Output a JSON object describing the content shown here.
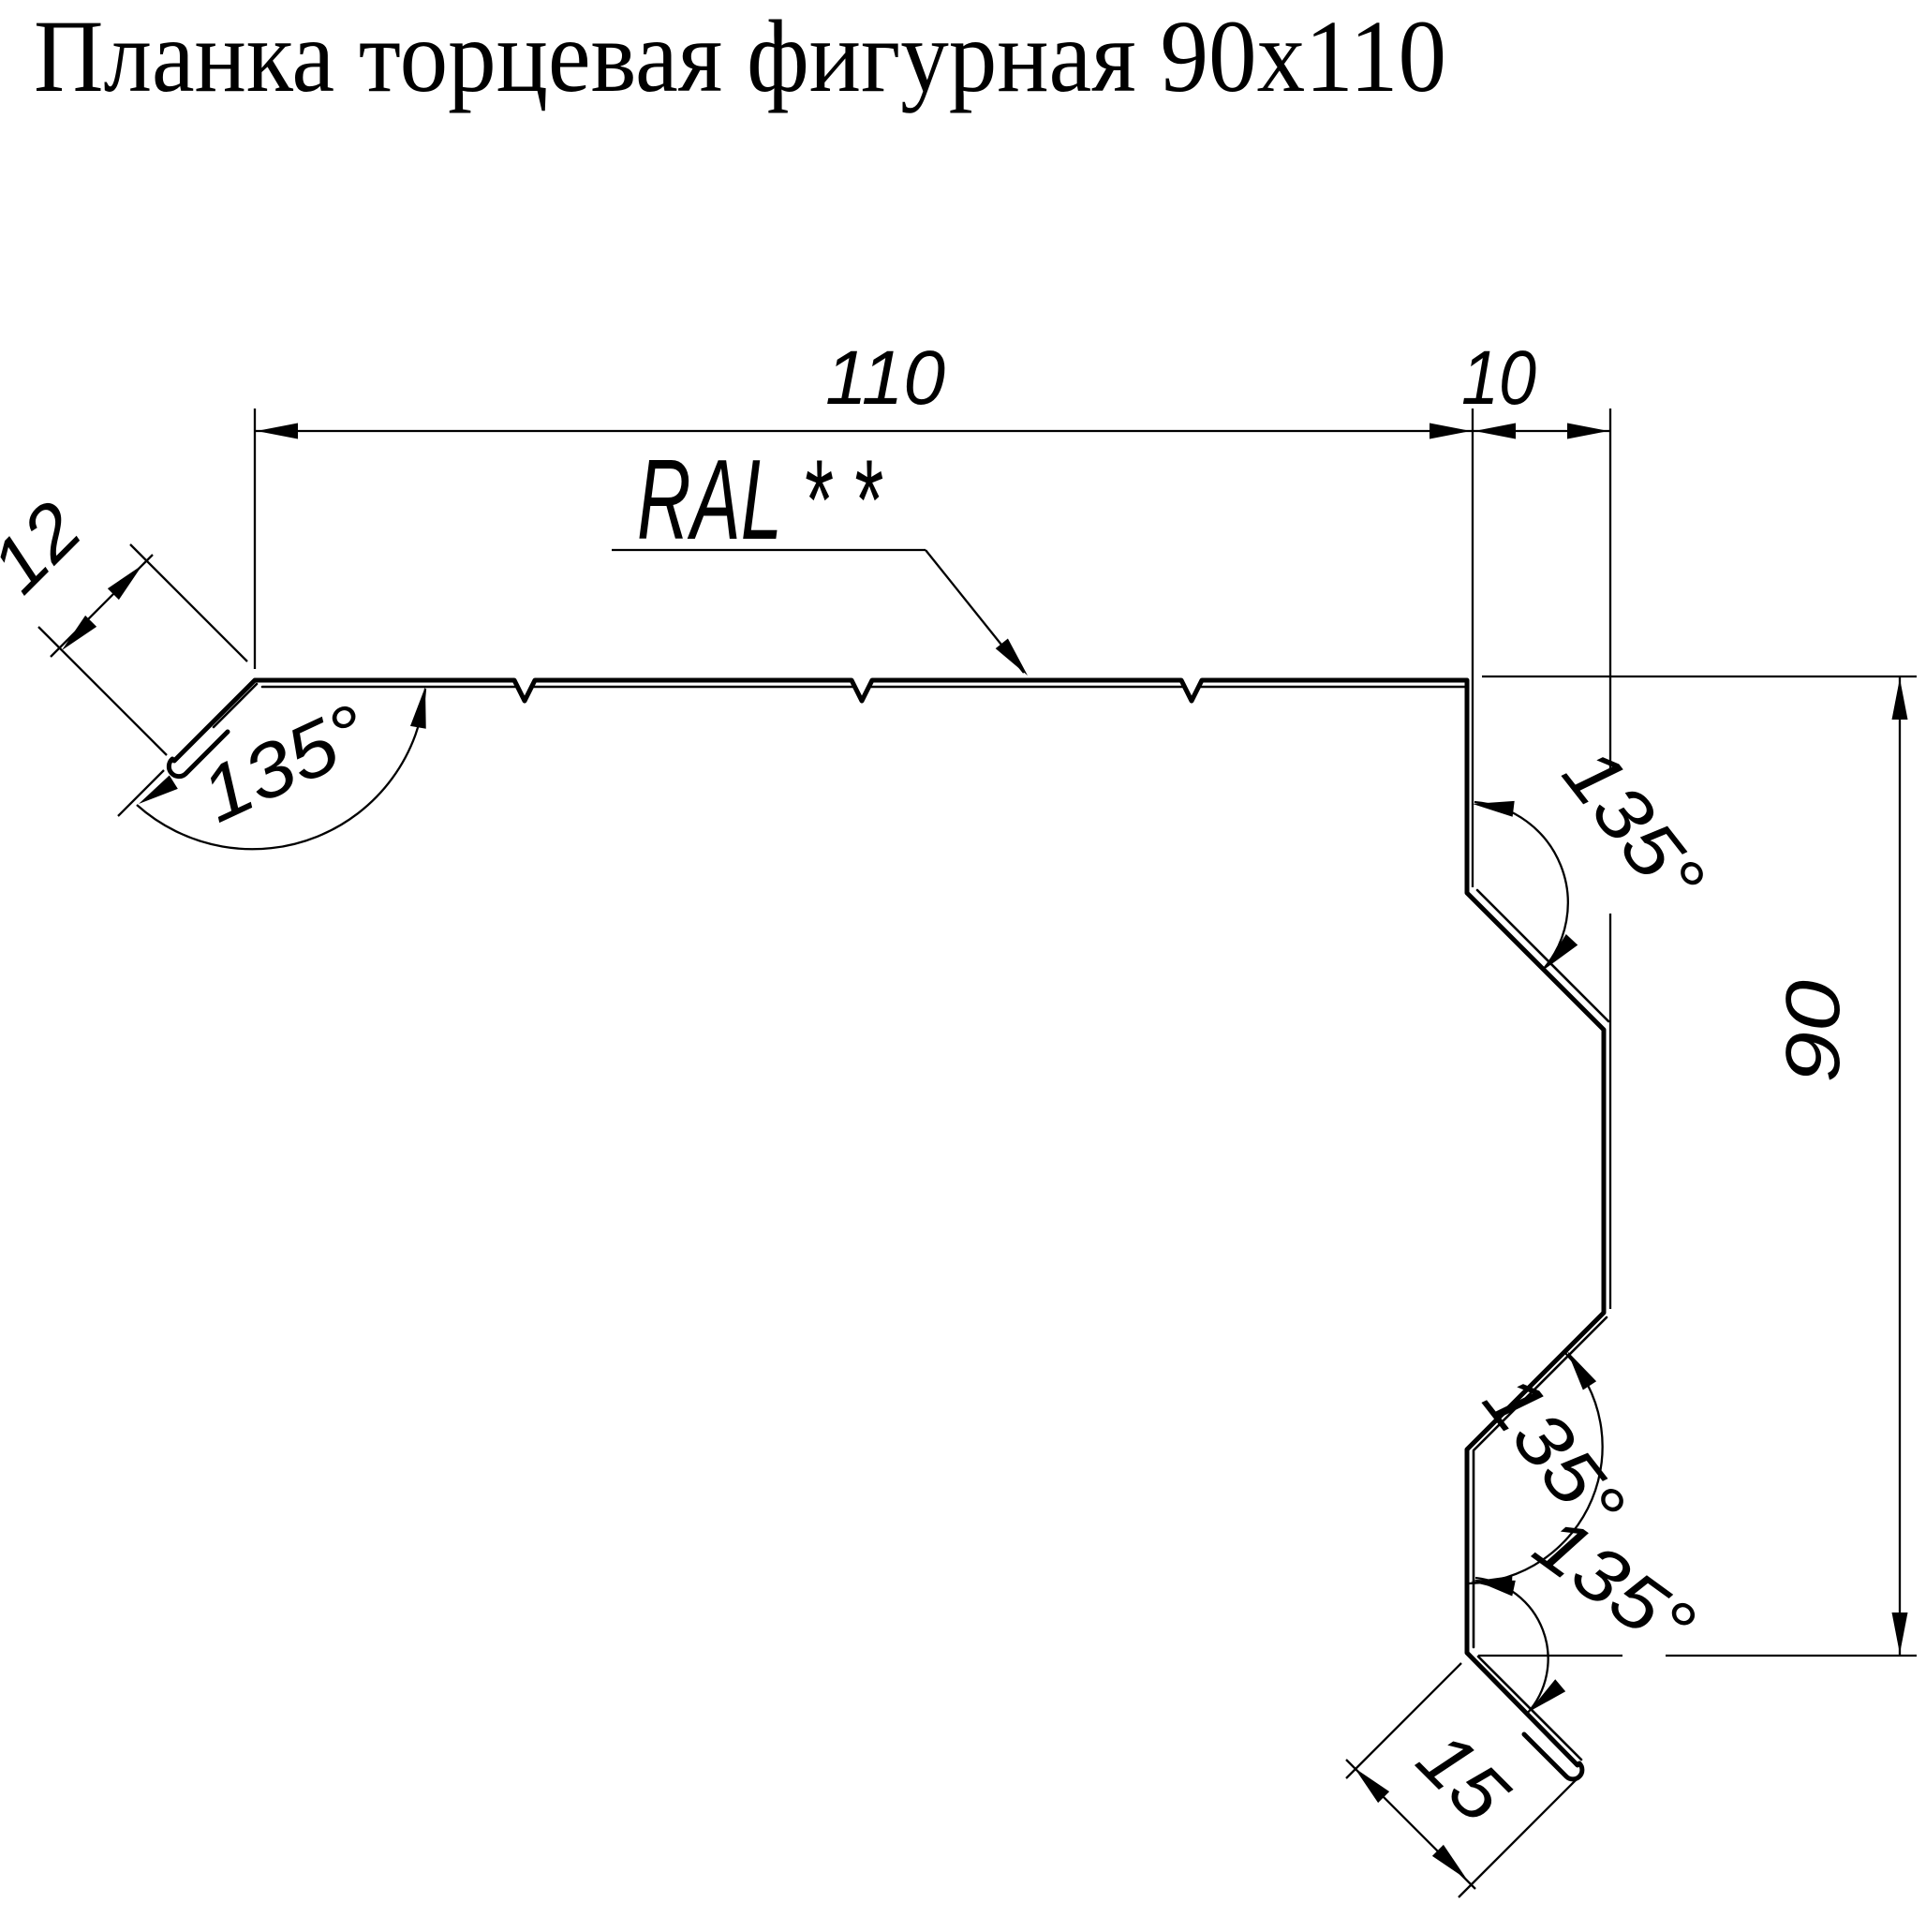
{
  "title": "Планка торцевая фигурная 90x110",
  "material_label": "RAL * *",
  "dimensions": {
    "top_width": "110",
    "top_offset": "10",
    "left_hem": "12",
    "right_height": "90",
    "bottom_tail": "15"
  },
  "angles": {
    "left_corner": "135°",
    "top_right_bend": "135°",
    "mid_right_bend": "135°",
    "bottom_corner": "135°"
  },
  "colors": {
    "line": "#000000",
    "background": "#ffffff"
  }
}
